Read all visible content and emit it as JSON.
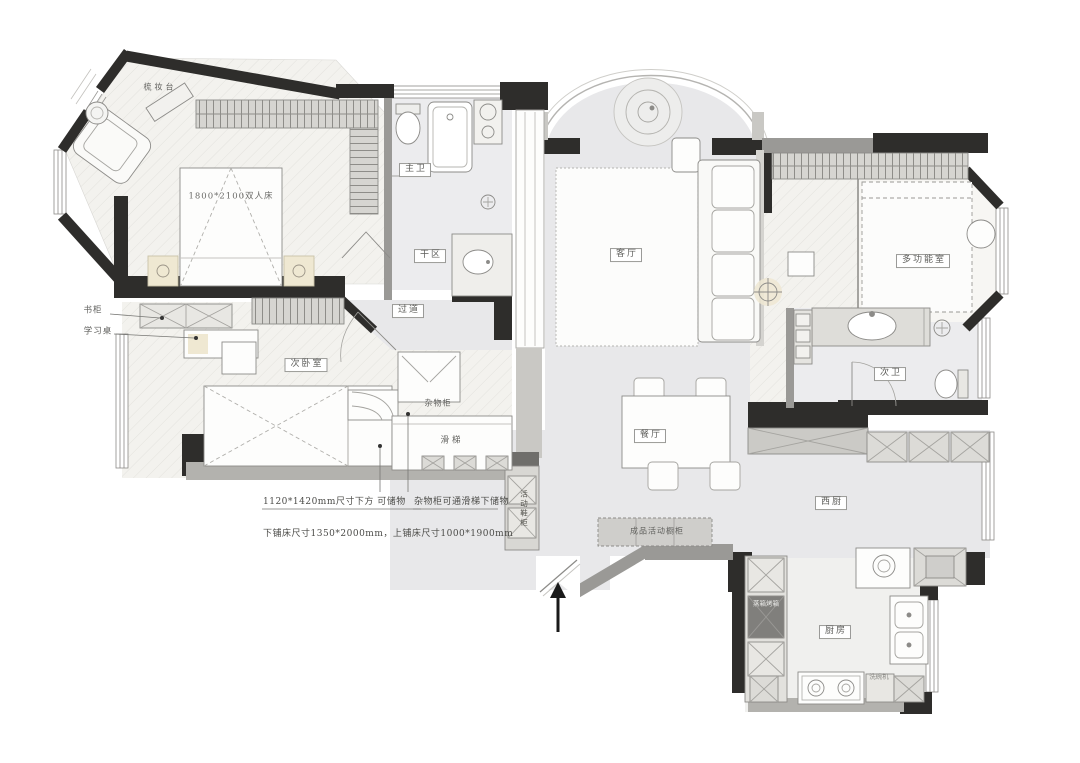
{
  "plan": {
    "type": "residential-floor-plan",
    "colors": {
      "wall": "#2e2d2b",
      "gray_wall": "#9a9996",
      "floor_gray": "#e8e8ea",
      "floor_herringbone": "#f3f2ee",
      "counter": "#cbcac6",
      "accent_glow": "#efe8d2"
    },
    "labels": {
      "dressing_table": "梳妆台",
      "master_bed_size": "1800*2100双人床",
      "master_bath": "主卫",
      "dry_area": "干区",
      "hallway": "过道",
      "living_room": "客厅",
      "multi_function_room": "多功能室",
      "second_bath": "次卫",
      "dining_room": "餐厅",
      "west_kitchen": "西厨",
      "kitchen": "厨房",
      "second_bedroom": "次卧室",
      "sundry_cabinet": "杂物柜",
      "slide": "滑梯",
      "bookcase": "书柜",
      "study_desk": "学习桌",
      "mobile_shoe_cabinet": "活动鞋柜",
      "mobile_cupboard": "成品活动橱柜",
      "steam_oven_cabinet": "蒸箱烤箱",
      "dishwasher": "洗碗机"
    },
    "annotations": {
      "under_bed_storage": "1120*1420mm尺寸下方 可储物",
      "cabinet_slide_storage": "杂物柜可通滑梯下储物",
      "bunk_bed_sizes": "下铺床尺寸1350*2000mm，上铺床尺寸1000*1900mm"
    }
  }
}
